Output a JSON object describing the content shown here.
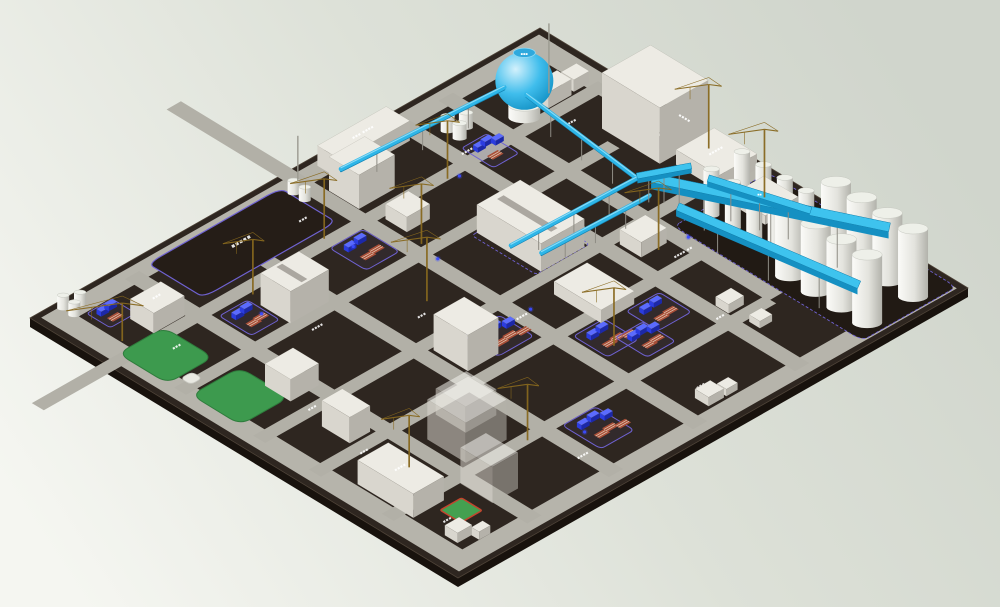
{
  "meta": {
    "type": "3d-plant-site-model",
    "description": "Isometric 3D rendering of an industrial plant construction site with buildings, gas sphere, pipelines, conveyors, silos, lawns, equipment yards and tower cranes",
    "note": "tiny white site labels in the source render are sub-pixel and illegible; they are represented as placeholder glyph runs"
  },
  "palette": {
    "bg_top": "#d0d5cc",
    "bg_bottom": "#f5f6f1",
    "plate_top": "#2e2620",
    "plate_side": "#18120d",
    "plate_edge": "#4d4237",
    "road": "#b2b0a7",
    "road_frame": "#b6b4ab",
    "building_top": "#edebe4",
    "building_left": "#d9d6ce",
    "building_right": "#b5b2aa",
    "ghost_top": "#f3f2ed",
    "pipe_blue": "#2eb6e8",
    "pipe_blue_hi": "#9fe2f8",
    "pipe_blue_dark": "#1283b4",
    "beam_top": "#3ec3ee",
    "beam_side": "#1590c2",
    "silo_top": "#eef0e9",
    "silo_edge": "#c6c8c0",
    "lawn": "#3d9a4e",
    "lawn_edge": "#2e7c3c",
    "court_green": "#44a050",
    "court_border": "#c4442e",
    "zone_purple": "#6f62d2",
    "machine_blue": "#2b3ce0",
    "machine_blue_top": "#5b6bff",
    "rack_red": "#a94f38",
    "rack_stripe": "#e3cdb8",
    "crane": "#87681e",
    "support": "#8e8c84",
    "label_white": "#ffffff",
    "plot_fill": "#251d17",
    "silo_pad": "#211a14",
    "led_blue": "#3b4cff"
  },
  "projection": {
    "origin": [
      30,
      318
    ],
    "u_axis": [
      510,
      -290
    ],
    "v_axis": [
      428,
      260
    ],
    "plate_thickness": 9
  },
  "roads": {
    "half_width": 0.014,
    "frame_outer": 0.012,
    "frame_inner": 0.052,
    "u_roads": [
      {
        "v": 0.185,
        "u0": -0.14,
        "u1": 0.97
      },
      {
        "v": 0.315,
        "u0": 0.03,
        "u1": 0.88
      },
      {
        "v": 0.5,
        "u0": 0.03,
        "u1": 0.88
      },
      {
        "v": 0.63,
        "u0": 0.03,
        "u1": 0.78
      },
      {
        "v": 0.8,
        "u0": 0.03,
        "u1": 0.78
      }
    ],
    "v_roads": [
      {
        "u": 0.175,
        "v0": 0.03,
        "v1": 0.97
      },
      {
        "u": 0.335,
        "v0": 0.03,
        "v1": 0.97
      },
      {
        "u": 0.5,
        "v0": -0.26,
        "v1": 0.97
      },
      {
        "u": 0.7,
        "v0": 0.03,
        "v1": 0.97
      },
      {
        "u": 0.79,
        "v0": 0.03,
        "v1": 0.8
      }
    ]
  },
  "zones": [
    {
      "name": "silo-pad",
      "u": 0.805,
      "v": 0.545,
      "du": 0.185,
      "dv": 0.44,
      "fill": "#211a14",
      "stroke": true
    },
    {
      "name": "center-zone",
      "u": 0.585,
      "v": 0.335,
      "du": 0.105,
      "dv": 0.15,
      "fill": "none",
      "stroke": true
    }
  ],
  "reserved_plot": {
    "u": 0.21,
    "v": 0.025,
    "du": 0.26,
    "dv": 0.13,
    "label": "▪▪▪▪▪",
    "label_size": 6
  },
  "lawns": [
    {
      "u": 0.03,
      "v": 0.17,
      "du": 0.09,
      "dv": 0.115
    },
    {
      "u": 0.035,
      "v": 0.335,
      "du": 0.095,
      "dv": 0.115
    }
  ],
  "plaza": {
    "u": 0.052,
    "v": 0.29,
    "du": 0.022,
    "dv": 0.024
  },
  "court": {
    "u": 0.095,
    "v": 0.845,
    "du": 0.042,
    "dv": 0.048
  },
  "buildings": [
    {
      "name": "north-long-building",
      "u": 0.545,
      "v": 0.022,
      "du": 0.135,
      "dv": 0.055,
      "h": 20,
      "roof_label": "▪▪▪ ▪▪▪▪"
    },
    {
      "name": "north-box-building",
      "u": 0.515,
      "v": 0.085,
      "du": 0.07,
      "dv": 0.07,
      "h": 34
    },
    {
      "name": "north-small-a",
      "u": 0.875,
      "v": 0.135,
      "du": 0.045,
      "dv": 0.034,
      "h": 16
    },
    {
      "name": "north-small-b",
      "u": 0.928,
      "v": 0.135,
      "du": 0.03,
      "dv": 0.03,
      "h": 12
    },
    {
      "name": "northeast-tall-building",
      "u": 0.895,
      "v": 0.27,
      "du": 0.095,
      "dv": 0.135,
      "h": 56,
      "face_label": "▪▪▪▪"
    },
    {
      "name": "east-flat-building-a",
      "u": 0.91,
      "v": 0.425,
      "du": 0.075,
      "dv": 0.1,
      "h": 15,
      "roof_label": "▪▪▪▪▪"
    },
    {
      "name": "east-flat-building-b",
      "u": 0.9,
      "v": 0.565,
      "du": 0.065,
      "dv": 0.08,
      "h": 9,
      "roof_label": "▪▪▪"
    },
    {
      "name": "central-long-building",
      "u": 0.595,
      "v": 0.335,
      "du": 0.085,
      "dv": 0.15,
      "h": 28,
      "roof_stripe": true
    },
    {
      "name": "central-flat-building",
      "u": 0.57,
      "v": 0.545,
      "du": 0.065,
      "dv": 0.11,
      "h": 13
    },
    {
      "name": "junction-building",
      "u": 0.72,
      "v": 0.52,
      "du": 0.05,
      "dv": 0.05,
      "h": 15
    },
    {
      "name": "west-big-building",
      "u": 0.255,
      "v": 0.235,
      "du": 0.075,
      "dv": 0.07,
      "h": 32,
      "roof_stripe": true
    },
    {
      "name": "west-box-building",
      "u": 0.1,
      "v": 0.115,
      "du": 0.06,
      "dv": 0.055,
      "h": 20,
      "roof_label": "▪▪▪"
    },
    {
      "name": "mid-box",
      "u": 0.525,
      "v": 0.205,
      "du": 0.045,
      "dv": 0.05,
      "h": 15
    },
    {
      "name": "southwest-building-a",
      "u": 0.125,
      "v": 0.4,
      "du": 0.055,
      "dv": 0.06,
      "h": 22
    },
    {
      "name": "southwest-building-b",
      "u": 0.115,
      "v": 0.545,
      "du": 0.04,
      "dv": 0.065,
      "h": 26
    },
    {
      "name": "south-long-building",
      "u": 0.055,
      "v": 0.7,
      "du": 0.06,
      "dv": 0.13,
      "h": 24,
      "roof_label": "▪▪▪▪"
    },
    {
      "name": "south-corner-box-a",
      "u": 0.058,
      "v": 0.9,
      "du": 0.028,
      "dv": 0.03,
      "h": 10
    },
    {
      "name": "south-corner-box-b",
      "u": 0.085,
      "v": 0.93,
      "du": 0.022,
      "dv": 0.018,
      "h": 8
    },
    {
      "name": "south-tiny-a",
      "u": 0.54,
      "v": 0.91,
      "du": 0.03,
      "dv": 0.032,
      "h": 9
    },
    {
      "name": "south-tiny-b",
      "u": 0.575,
      "v": 0.92,
      "du": 0.022,
      "dv": 0.022,
      "h": 7
    },
    {
      "name": "mid-tiny-a",
      "u": 0.715,
      "v": 0.75,
      "du": 0.03,
      "dv": 0.03,
      "h": 9
    },
    {
      "name": "mid-tiny-b",
      "u": 0.722,
      "v": 0.82,
      "du": 0.024,
      "dv": 0.025,
      "h": 7
    },
    {
      "name": "central-tall-building",
      "u": 0.355,
      "v": 0.52,
      "du": 0.06,
      "dv": 0.08,
      "h": 36
    },
    {
      "name": "planned-building-a",
      "u": 0.2,
      "v": 0.69,
      "du": 0.08,
      "dv": 0.09,
      "h": 40,
      "ghost": true
    },
    {
      "name": "planned-building-b",
      "u": 0.16,
      "v": 0.815,
      "du": 0.05,
      "dv": 0.075,
      "h": 36,
      "ghost": true
    },
    {
      "name": "planned-building-c",
      "u": 0.25,
      "v": 0.65,
      "du": 0.06,
      "dv": 0.07,
      "h": 26,
      "ghost": true
    }
  ],
  "cylinder_groups": [
    {
      "name": "tank-trio-north",
      "u": 0.735,
      "v": 0.1,
      "r": 7,
      "h": 15,
      "offsets": [
        [
          0,
          0
        ],
        [
          0,
          0.028
        ],
        [
          0.024,
          0.014
        ]
      ]
    },
    {
      "name": "tank-pair-north",
      "u": 0.475,
      "v": 0.05,
      "r": 6,
      "h": 13,
      "offsets": [
        [
          0,
          0
        ],
        [
          0,
          0.026
        ]
      ]
    },
    {
      "name": "tank-trio-west",
      "u": 0.05,
      "v": 0.018,
      "r": 6,
      "h": 13,
      "offsets": [
        [
          0,
          0
        ],
        [
          0,
          0.026
        ],
        [
          0.022,
          0.013
        ]
      ]
    }
  ],
  "gas_sphere": {
    "u": 0.835,
    "v": 0.16,
    "r": 29,
    "base_h": 12,
    "label": "▪▪▪"
  },
  "silos": {
    "thin": {
      "u_rows": [
        0.862,
        0.922
      ],
      "v_list": [
        0.565,
        0.615,
        0.665,
        0.715
      ],
      "r": 8,
      "h": 46
    },
    "big": {
      "u_rows": [
        0.84,
        0.93
      ],
      "v_list": [
        0.775,
        0.835,
        0.895,
        0.955
      ],
      "r": 15,
      "h": 68
    }
  },
  "yards": [
    {
      "u": 0.065,
      "v": 0.055,
      "du": 0.05,
      "dv": 0.055,
      "machines": 2,
      "racks": 1
    },
    {
      "u": 0.195,
      "v": 0.21,
      "du": 0.055,
      "dv": 0.075,
      "machines": 2,
      "racks": 2
    },
    {
      "u": 0.42,
      "v": 0.2,
      "du": 0.065,
      "dv": 0.085,
      "machines": 2,
      "racks": 2
    },
    {
      "u": 0.72,
      "v": 0.15,
      "du": 0.05,
      "dv": 0.075,
      "machines": 3,
      "racks": 1
    },
    {
      "u": 0.41,
      "v": 0.525,
      "du": 0.07,
      "dv": 0.08,
      "machines": 3,
      "racks": 3
    },
    {
      "u": 0.52,
      "v": 0.65,
      "du": 0.06,
      "dv": 0.08,
      "machines": 2,
      "racks": 3
    },
    {
      "u": 0.615,
      "v": 0.66,
      "du": 0.065,
      "dv": 0.075,
      "machines": 2,
      "racks": 2
    },
    {
      "u": 0.36,
      "v": 0.815,
      "du": 0.065,
      "dv": 0.09,
      "machines": 3,
      "racks": 3
    },
    {
      "u": 0.56,
      "v": 0.7,
      "du": 0.055,
      "dv": 0.075,
      "machines": 3,
      "racks": 2
    }
  ],
  "pipes": [
    {
      "a": [
        0.835,
        0.165,
        24
      ],
      "b": [
        0.808,
        0.455,
        24
      ]
    },
    {
      "a": [
        0.825,
        0.125,
        24
      ],
      "b": [
        0.53,
        0.095,
        20
      ]
    },
    {
      "a": [
        0.808,
        0.455,
        24
      ],
      "b": [
        0.578,
        0.435,
        18
      ]
    },
    {
      "a": [
        0.795,
        0.5,
        22
      ],
      "b": [
        0.6,
        0.48,
        16
      ]
    }
  ],
  "beams": [
    {
      "a": [
        0.8,
        0.5,
        38
      ],
      "b": [
        0.93,
        0.9,
        55
      ],
      "w": 9,
      "label": "▪▪▪"
    },
    {
      "a": [
        0.8,
        0.56,
        25
      ],
      "b": [
        0.82,
        0.96,
        45
      ],
      "w": 8
    },
    {
      "a": [
        0.86,
        0.56,
        36
      ],
      "b": [
        0.91,
        0.74,
        36
      ],
      "w": 7,
      "label": "▪▪"
    },
    {
      "a": [
        0.808,
        0.455,
        26
      ],
      "b": [
        0.86,
        0.52,
        38
      ],
      "w": 6
    }
  ],
  "cranes": [
    [
      0.43,
      0.175,
      60,
      34
    ],
    [
      0.265,
      0.205,
      55,
      30
    ],
    [
      0.43,
      0.415,
      64,
      36
    ],
    [
      0.655,
      0.195,
      58,
      32
    ],
    [
      0.75,
      0.575,
      62,
      34
    ],
    [
      0.945,
      0.59,
      68,
      36
    ],
    [
      0.3,
      0.805,
      56,
      30
    ],
    [
      0.135,
      0.725,
      52,
      28
    ],
    [
      0.545,
      0.715,
      58,
      32
    ],
    [
      0.52,
      0.295,
      60,
      32
    ],
    [
      0.97,
      0.43,
      64,
      34
    ],
    [
      0.055,
      0.15,
      38,
      56
    ]
  ],
  "poles": [
    [
      0.9,
      0.14,
      70
    ],
    [
      0.5,
      0.03,
      45
    ]
  ],
  "leds": [
    [
      0.67,
      0.205
    ],
    [
      0.445,
      0.225
    ],
    [
      0.51,
      0.345
    ],
    [
      0.8,
      0.585
    ],
    [
      0.845,
      0.6
    ],
    [
      0.37,
      0.855
    ],
    [
      0.52,
      0.55
    ],
    [
      0.24,
      0.255
    ]
  ],
  "labels": [
    {
      "u": 0.56,
      "v": 0.115,
      "t": "▪▪▪ ▪▪▪▪"
    },
    {
      "u": 0.44,
      "v": 0.115,
      "t": "▪▪▪"
    },
    {
      "u": 0.72,
      "v": 0.165,
      "t": "▪▪▪▪"
    },
    {
      "u": 0.63,
      "v": 0.425,
      "t": "▪▪▪▪ ▪▪"
    },
    {
      "u": 0.5,
      "v": 0.555,
      "t": "▪▪▪▪"
    },
    {
      "u": 0.4,
      "v": 0.44,
      "t": "▪▪▪"
    },
    {
      "u": 0.275,
      "v": 0.345,
      "t": "▪▪▪▪"
    },
    {
      "u": 0.1,
      "v": 0.225,
      "t": "▪▪▪"
    },
    {
      "u": 0.135,
      "v": 0.5,
      "t": "▪▪▪"
    },
    {
      "u": 0.115,
      "v": 0.645,
      "t": "▪▪▪"
    },
    {
      "u": 0.085,
      "v": 0.875,
      "t": "▪▪▪"
    },
    {
      "u": 0.33,
      "v": 0.9,
      "t": "▪▪▪▪"
    },
    {
      "u": 0.565,
      "v": 0.895,
      "t": "▪▪▪"
    },
    {
      "u": 0.7,
      "v": 0.78,
      "t": "▪▪▪"
    },
    {
      "u": 0.77,
      "v": 0.61,
      "t": "▪▪▪▪ ▪▪"
    },
    {
      "u": 0.875,
      "v": 0.225,
      "t": "▪▪▪"
    },
    {
      "u": 0.94,
      "v": 0.35,
      "t": "▪▪▪▪"
    }
  ]
}
